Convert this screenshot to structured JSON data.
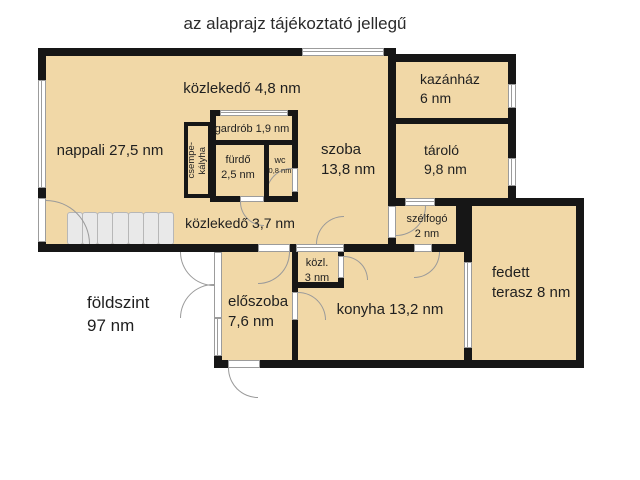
{
  "header": {
    "title": "az alaprajz tájékoztató jellegű"
  },
  "rooms": [
    {
      "id": "nappali",
      "line1": "nappali 27,5 nm",
      "line2": ""
    },
    {
      "id": "kozlekedo-felso",
      "line1": "közlekedő 4,8 nm",
      "line2": ""
    },
    {
      "id": "kazanhaz",
      "line1": "kazánház",
      "line2": "6 nm"
    },
    {
      "id": "tarolo",
      "line1": "tároló",
      "line2": "9,8 nm"
    },
    {
      "id": "gardrob",
      "line1": "gardrób 1,9 nm",
      "line2": ""
    },
    {
      "id": "csempekalyha",
      "line1": "csempe-",
      "line2": "kályha"
    },
    {
      "id": "furdo",
      "line1": "fürdő",
      "line2": "2,5 nm"
    },
    {
      "id": "wc",
      "line1": "wc",
      "line2": "0,8 nm"
    },
    {
      "id": "szoba",
      "line1": "szoba",
      "line2": "13,8 nm"
    },
    {
      "id": "kozlekedo-also",
      "line1": "közlekedő 3,7 nm",
      "line2": ""
    },
    {
      "id": "szelfogo",
      "line1": "szélfogó",
      "line2": "2 nm"
    },
    {
      "id": "kozl",
      "line1": "közl.",
      "line2": "3 nm"
    },
    {
      "id": "eloszoba",
      "line1": "előszoba",
      "line2": "7,6 nm"
    },
    {
      "id": "konyha",
      "line1": "konyha 13,2 nm",
      "line2": ""
    },
    {
      "id": "fedett-terasz",
      "line1": "fedett",
      "line2": "terasz 8 nm"
    }
  ],
  "summary": {
    "line1": "földszint",
    "line2": "97 nm"
  },
  "colors": {
    "floor": "#f1d8a7",
    "wall": "#161616",
    "window_frame": "#9c9c9c",
    "door_arc": "#9a9a9a",
    "stairs_fill": "#e9e9e9",
    "stairs_border": "#b7b7b7",
    "text": "#1f1f1f",
    "background": "#ffffff"
  }
}
